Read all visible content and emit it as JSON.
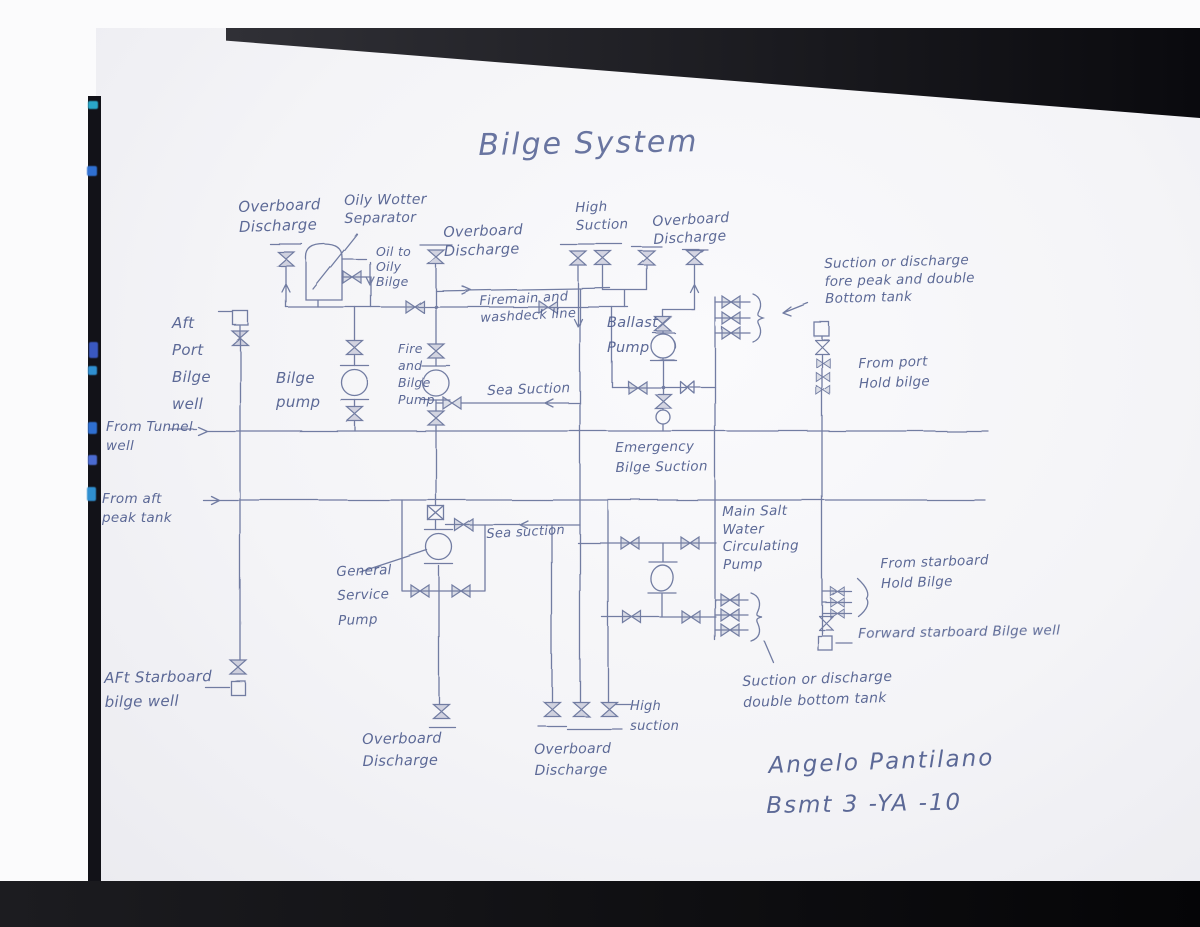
{
  "title": "Bilge System",
  "signature": {
    "name": "Angelo Pantilano",
    "class_line": "Bsmt 3 -YA -10"
  },
  "colors": {
    "ink": "#55628f",
    "paper": "#f4f4f7",
    "desk": "#0a0a0e",
    "artifact_blue": "#2f6fd0",
    "artifact_teal": "#2aa7c8"
  },
  "labels": {
    "ob_top_left": "Overboard\nDischarge",
    "oily_separator": "Oily Wotter\nSeparator",
    "oil_to_bilge": "Oil to\nOily\nBilge",
    "ob_top_mid": "Overboard\nDischarge",
    "high_suction_top": "High\nSuction",
    "ob_top_right": "Overboard\nDischarge",
    "note_fore_peak": "Suction or discharge\nfore peak and double\nBottom tank",
    "firemain": "Firemain and\nwashdeck line",
    "ballast_pump": "Ballast\nPump",
    "aft_port_well": "Aft\nPort\nBilge\nwell",
    "bilge_pump": "Bilge\npump",
    "fire_bilge_pump": "Fire\nand\nBilge\nPump",
    "sea_suction_upper": "Sea Suction",
    "from_port_hold": "From port\nHold bilge",
    "from_tunnel": "From Tunnel\nwell",
    "emergency": "Emergency\nBilge Suction",
    "from_aft_peak": "From aft\npeak tank",
    "msw_pump": "Main Salt\nWater\nCirculating\nPump",
    "general_service": "General\nService\nPump",
    "sea_suction_lower": "Sea suction",
    "from_stbd_hold": "From starboard\nHold Bilge",
    "fwd_stbd_well": "Forward starboard Bilge well",
    "aft_stbd_well": "AFt Starboard\nbilge well",
    "note_double_bottom": "Suction or discharge\ndouble bottom tank",
    "high_suction_bottom": "High\nsuction",
    "ob_bottom_left": "Overboard\nDischarge",
    "ob_bottom_mid": "Overboard\nDischarge"
  }
}
